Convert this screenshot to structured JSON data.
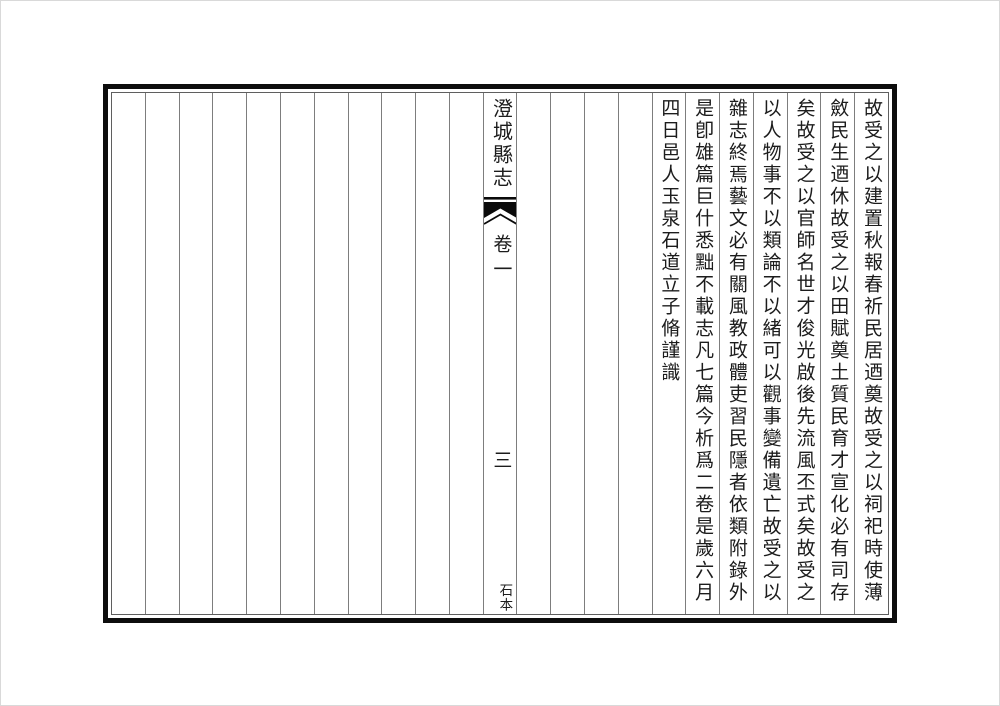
{
  "doc": {
    "title": "澄城縣志",
    "volume": "卷一",
    "page_number": "三",
    "edition_note": "石本",
    "columns": [
      "故受之以建置秋報春祈民居迺奠故受之以祠祀時使薄",
      "斂民生迺休故受之以田賦奠土質民育才宣化必有司存",
      "矣故受之以官師名世才俊光啟後先流風丕式矣故受之",
      "以人物事不以類論不以緒可以觀事變備遺亡故受之以",
      "雜志終焉藝文必有關風教政體吏習民隱者依類附錄外",
      "是卽雄篇巨什悉黜不載志凡七篇今析爲二卷是歲六月",
      "四日邑人玉泉石道立子脩謹識"
    ]
  },
  "colors": {
    "frame": "#0d0d0d",
    "rule": "#7d7d7d",
    "ink": "#1c1c1c",
    "paper": "#ffffff",
    "fishtail": "#0a0a0a"
  }
}
